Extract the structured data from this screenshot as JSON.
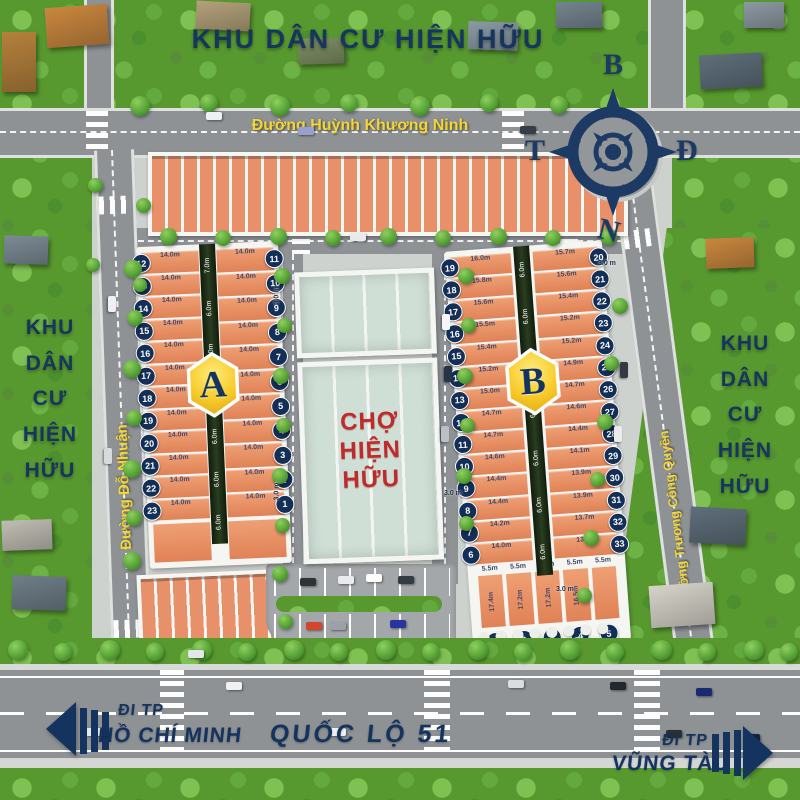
{
  "area_labels": {
    "top": "KHU DÂN CƯ HIỆN HỮU",
    "left_lines": [
      "KHU",
      "DÂN",
      "CƯ",
      "HIỆN",
      "HỮU"
    ],
    "right_lines": [
      "KHU",
      "DÂN",
      "CƯ",
      "HIỆN",
      "HỮU"
    ]
  },
  "streets": {
    "top": "Đường Huỳnh Khương Ninh",
    "left": "Đường Đỗ Nhuận",
    "right": "Đường Trương Công Quyền",
    "highway": "QUỐC LỘ 51"
  },
  "directions": {
    "left": {
      "line1": "ĐI TP",
      "line2": "HỒ CHÍ MINH"
    },
    "right": {
      "line1": "ĐI TP",
      "line2": "VŨNG TÀU"
    }
  },
  "compass": {
    "north": "B",
    "east": "Đ",
    "south": "N",
    "west": "T"
  },
  "market": {
    "lines": [
      "CHỢ",
      "HIỆN",
      "HỮU"
    ]
  },
  "dimension_tags": [
    "3.0 m",
    "3.0 m",
    "3.0 m",
    "3.0 m",
    "3.0 m"
  ],
  "blocks": {
    "a": {
      "badge": "A",
      "alley_top": "7.0m",
      "alley": "6.0m",
      "left_lots": [
        {
          "n": "12",
          "d": "14.0m"
        },
        {
          "n": "13",
          "d": "14.0m"
        },
        {
          "n": "14",
          "d": "14.0m"
        },
        {
          "n": "15",
          "d": "14.0m"
        },
        {
          "n": "16",
          "d": "14.0m"
        },
        {
          "n": "17",
          "d": "14.0m"
        },
        {
          "n": "18",
          "d": "14.0m"
        },
        {
          "n": "19",
          "d": "14.0m"
        },
        {
          "n": "20",
          "d": "14.0m"
        },
        {
          "n": "21",
          "d": "14.0m"
        },
        {
          "n": "22",
          "d": "14.0m"
        },
        {
          "n": "23",
          "d": "14.0m"
        }
      ],
      "right_lots": [
        {
          "n": "11",
          "d": "14.0m"
        },
        {
          "n": "10",
          "d": "14.0m"
        },
        {
          "n": "9",
          "d": "14.0m"
        },
        {
          "n": "8",
          "d": "14.0m"
        },
        {
          "n": "7",
          "d": "14.0m"
        },
        {
          "n": "6",
          "d": "14.0m"
        },
        {
          "n": "5",
          "d": "14.0m"
        },
        {
          "n": "4",
          "d": "14.0m"
        },
        {
          "n": "3",
          "d": "14.0m"
        },
        {
          "n": "2",
          "d": "14.0m"
        },
        {
          "n": "1",
          "d": "14.0m"
        }
      ]
    },
    "b": {
      "badge": "B",
      "alley": "6.0m",
      "left_lots": [
        {
          "n": "19",
          "d": "16.0m"
        },
        {
          "n": "18",
          "d": "15.8m"
        },
        {
          "n": "17",
          "d": "15.6m"
        },
        {
          "n": "16",
          "d": "15.5m"
        },
        {
          "n": "15",
          "d": "15.4m"
        },
        {
          "n": "14",
          "d": "15.2m"
        },
        {
          "n": "13",
          "d": "15.0m"
        },
        {
          "n": "12",
          "d": "14.7m"
        },
        {
          "n": "11",
          "d": "14.7m"
        },
        {
          "n": "10",
          "d": "14.6m"
        },
        {
          "n": "9",
          "d": "14.4m"
        },
        {
          "n": "8",
          "d": "14.4m"
        },
        {
          "n": "7",
          "d": "14.2m"
        },
        {
          "n": "6",
          "d": "14.0m"
        }
      ],
      "right_lots": [
        {
          "n": "20",
          "d": "15.7m"
        },
        {
          "n": "21",
          "d": "15.6m"
        },
        {
          "n": "22",
          "d": "15.4m"
        },
        {
          "n": "23",
          "d": "15.2m"
        },
        {
          "n": "24",
          "d": "15.2m"
        },
        {
          "n": "25",
          "d": "14.9m"
        },
        {
          "n": "26",
          "d": "14.7m"
        },
        {
          "n": "27",
          "d": "14.6m"
        },
        {
          "n": "28",
          "d": "14.4m"
        },
        {
          "n": "29",
          "d": "14.1m"
        },
        {
          "n": "30",
          "d": "13.9m"
        },
        {
          "n": "31",
          "d": "13.9m"
        },
        {
          "n": "32",
          "d": "13.7m"
        },
        {
          "n": "33",
          "d": "13.5m"
        }
      ],
      "bottom_lots": [
        {
          "n": "1",
          "w": "5.5m",
          "d": "17.4m"
        },
        {
          "n": "2",
          "w": "5.5m",
          "d": "17.2m"
        },
        {
          "n": "3",
          "w": "5.5m",
          "d": "17.2m"
        },
        {
          "n": "4",
          "w": "5.5m",
          "d": "16.5m"
        },
        {
          "n": "5",
          "w": "5.5m",
          "d": ""
        }
      ]
    }
  },
  "colors": {
    "navy": "#16355f",
    "accent_yellow": "#f2d43c",
    "lot_orange": "#e8906a",
    "market_red": "#bf2a2c"
  }
}
